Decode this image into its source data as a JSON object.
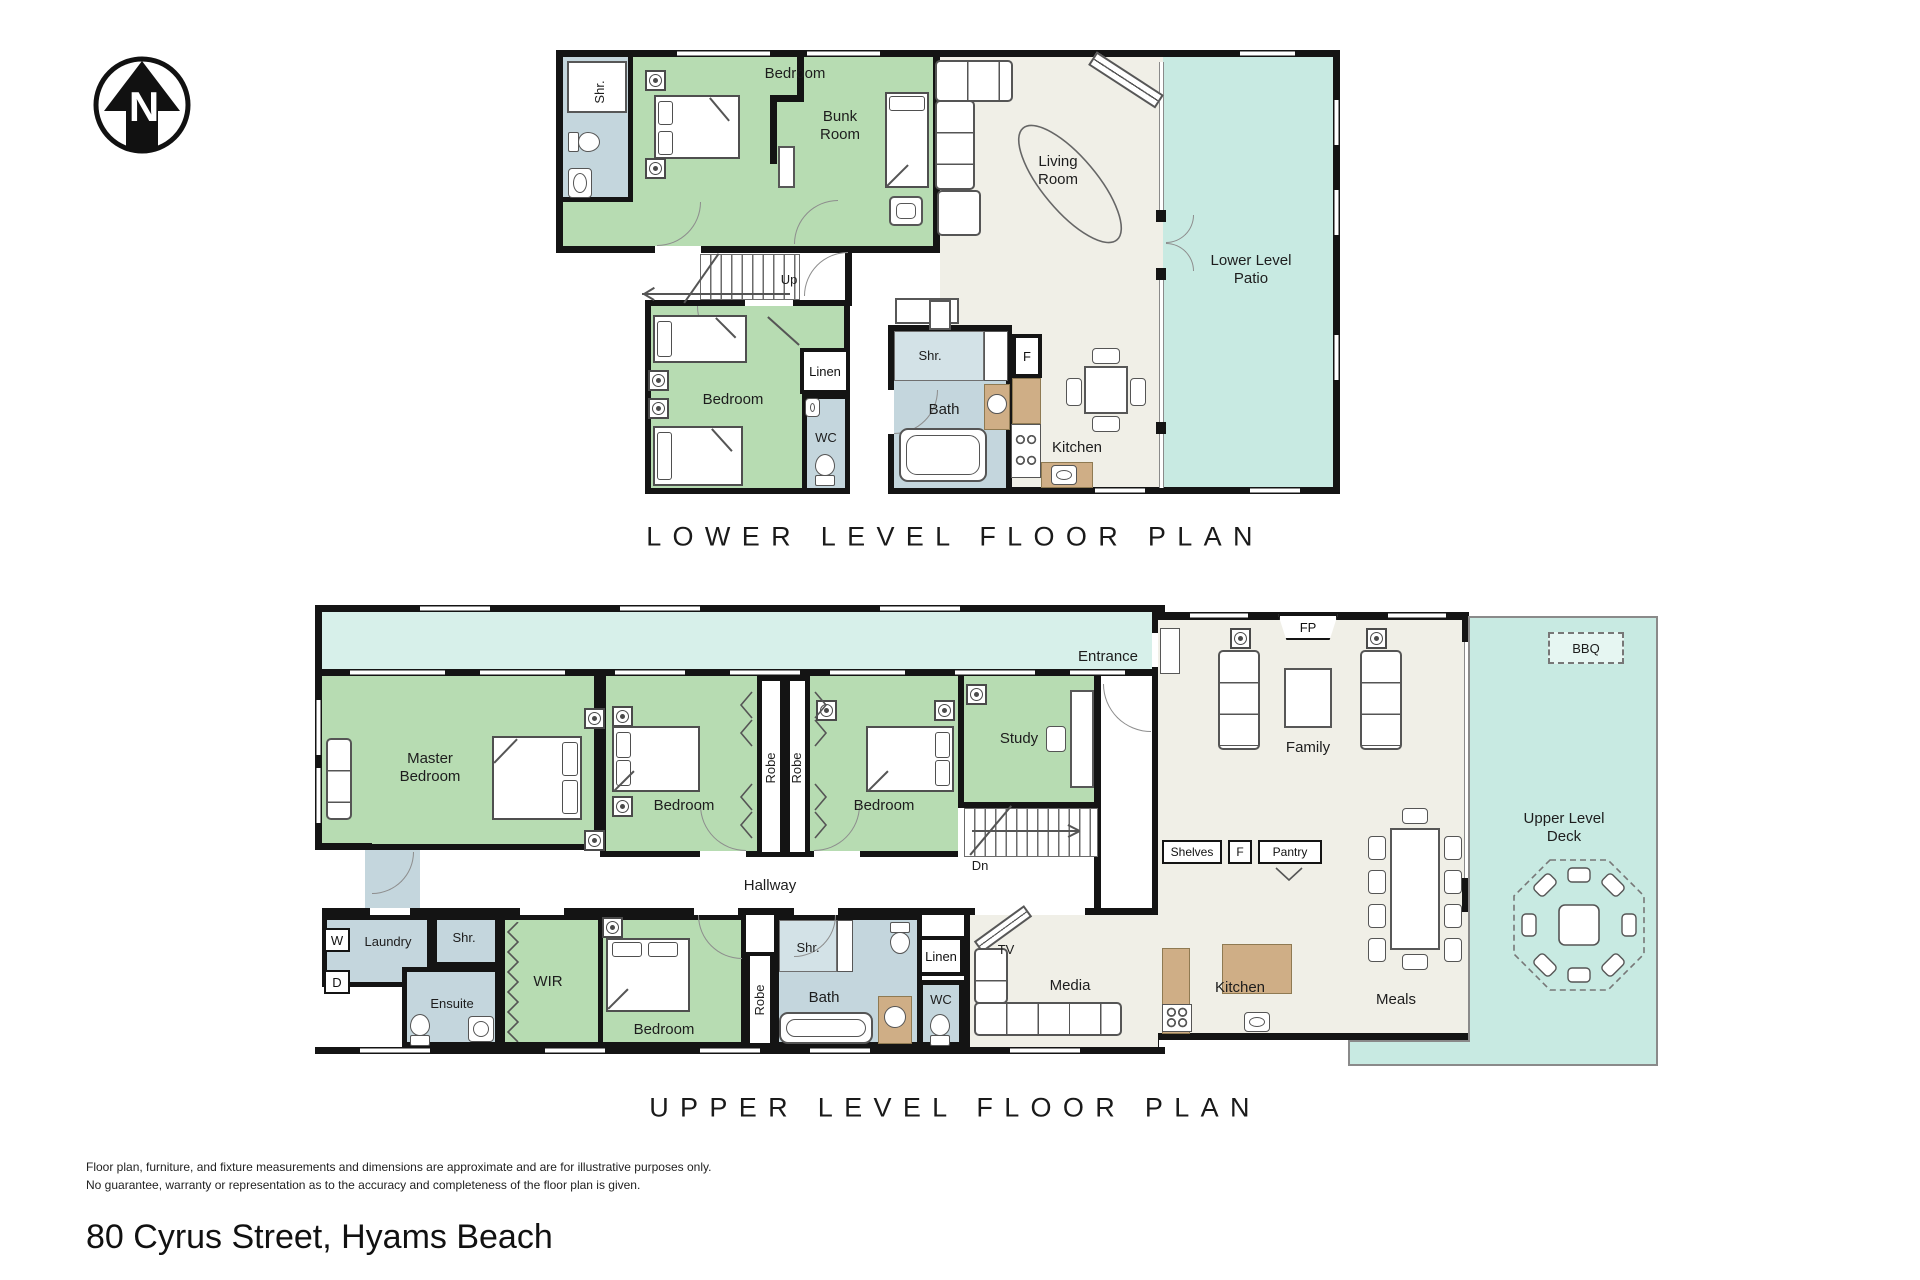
{
  "meta": {
    "compass_n": "N",
    "address": "80 Cyrus Street, Hyams Beach",
    "disclaimer1": "Floor plan, furniture, and fixture measurements and dimensions are approximate and are for illustrative purposes only.",
    "disclaimer2": "No guarantee, warranty or representation as to the accuracy and completeness of the floor plan is given."
  },
  "colors": {
    "bedroom_green": "#b7dcb2",
    "wet_area_blue": "#c4d6dd",
    "outdoor_teal": "#c8eae2",
    "balcony_teal_light": "#d7f0ea",
    "living_cream": "#f0efe7",
    "bench_tan": "#cfae86",
    "wall_black": "#141414"
  },
  "lower": {
    "title": "LOWER LEVEL FLOOR PLAN",
    "rooms": {
      "shr": "Shr.",
      "bedroom_top": "Bedroom",
      "bunk_room": "Bunk\nRoom",
      "living_room": "Living\nRoom",
      "patio": "Lower Level\nPatio",
      "up": "Up",
      "bedroom_mid": "Bedroom",
      "linen": "Linen",
      "wc": "WC",
      "shr2": "Shr.",
      "bath": "Bath",
      "fridge": "F",
      "kitchen": "Kitchen"
    }
  },
  "upper": {
    "title": "UPPER LEVEL FLOOR PLAN",
    "rooms": {
      "entrance": "Entrance",
      "master": "Master\nBedroom",
      "bedroom2": "Bedroom",
      "robe1": "Robe",
      "robe2": "Robe",
      "bedroom3": "Bedroom",
      "study": "Study",
      "fp": "FP",
      "family": "Family",
      "bbq": "BBQ",
      "deck": "Upper Level\nDeck",
      "shelves": "Shelves",
      "fridge": "F",
      "pantry": "Pantry",
      "dn": "Dn",
      "hallway": "Hallway",
      "washer": "W",
      "laundry": "Laundry",
      "dryer": "D",
      "shr1": "Shr.",
      "ensuite": "Ensuite",
      "wir": "WIR",
      "bedroom4": "Bedroom",
      "robe3": "Robe",
      "shr2": "Shr.",
      "bath": "Bath",
      "linen": "Linen",
      "tv": "TV",
      "wc": "WC",
      "media": "Media",
      "kitchen": "Kitchen",
      "meals": "Meals"
    }
  }
}
